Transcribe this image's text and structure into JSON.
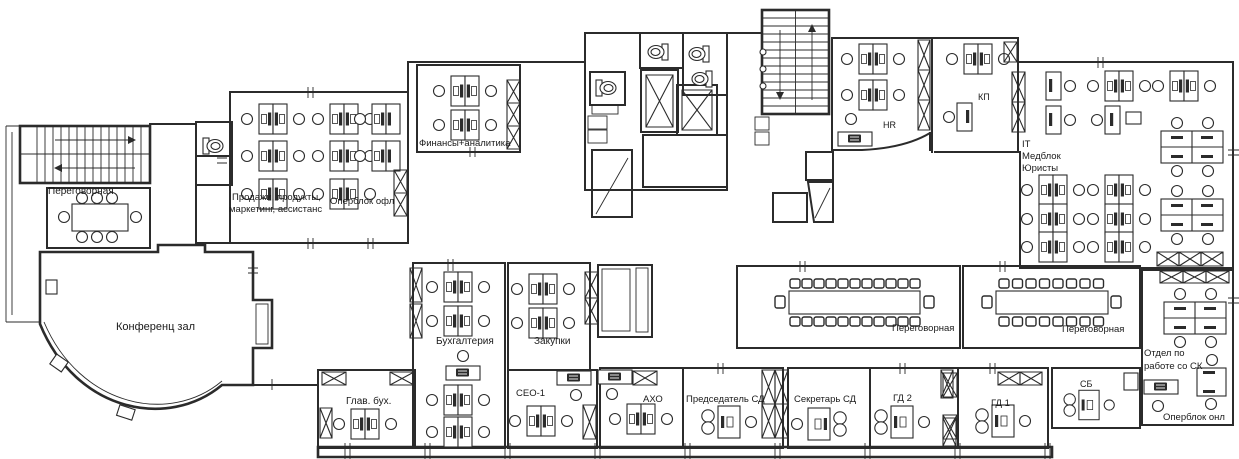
{
  "colors": {
    "wall": "#2b2b2b",
    "background": "#ffffff",
    "text": "#1a1a1a"
  },
  "rooms": {
    "meeting_nw": {
      "label": "Переговорная"
    },
    "conference_hall": {
      "label": "Конференц зал"
    },
    "sales": {
      "line1": "Продажи, продукты,",
      "line2": "маркетинг, ассистанс"
    },
    "operblock_ofl": {
      "label": "Оперблок офл"
    },
    "finance": {
      "label": "Финансы+аналитика"
    },
    "hr": {
      "label": "HR"
    },
    "kp": {
      "label": "КП"
    },
    "it": {
      "line1": "IT",
      "line2": "Медблок",
      "line3": "Юристы"
    },
    "meeting_mid_left": {
      "label": "Переговорная"
    },
    "meeting_mid_right": {
      "label": "Переговорная"
    },
    "sk_dept": {
      "line1": "Отдел по",
      "line2": "работе со СК"
    },
    "operblock_onl": {
      "label": "Оперблок онл"
    },
    "accounting": {
      "label": "Бухгалтерия"
    },
    "procurement": {
      "label": "Закупки"
    },
    "chief_accountant": {
      "label": "Глав. бух."
    },
    "ceo": {
      "label": "СЕО-1"
    },
    "aho": {
      "label": "АХО"
    },
    "chairman": {
      "label": "Председатель СД"
    },
    "secretary": {
      "label": "Секретарь СД"
    },
    "gd2": {
      "label": "ГД 2"
    },
    "gd1": {
      "label": "ГД 1"
    },
    "sb": {
      "label": "СБ"
    }
  }
}
